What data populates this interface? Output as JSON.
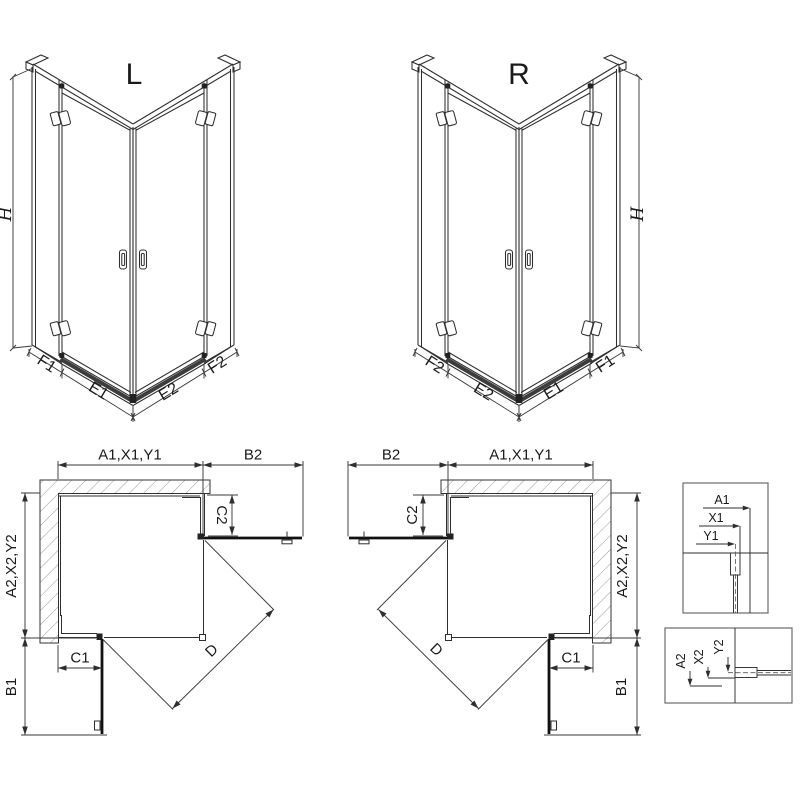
{
  "drawing": {
    "type": "shower-enclosure-technical-drawing",
    "iso_left": {
      "title": "L",
      "height": "H",
      "f1": "F1",
      "e1": "E1",
      "e2": "E2",
      "f2": "F2"
    },
    "iso_right": {
      "title": "R",
      "height": "H",
      "f1": "F1",
      "e1": "E1",
      "e2": "E2",
      "f2": "F2"
    },
    "plan_left": {
      "top_width": "A1,X1,Y1",
      "door_top": "B2",
      "offset_top": "C2",
      "side_width": "A2,X2,Y2",
      "offset_side": "C1",
      "door_side": "B1",
      "diagonal": "D"
    },
    "plan_right": {
      "top_width": "A1,X1,Y1",
      "door_top": "B2",
      "offset_top": "C2",
      "side_width": "A2,X2,Y2",
      "offset_side": "C1",
      "door_side": "B1",
      "diagonal": "D"
    },
    "detail_top": {
      "a": "A1",
      "x": "X1",
      "y": "Y1"
    },
    "detail_bottom": {
      "a": "A2",
      "x": "X2",
      "y": "Y2"
    },
    "colors": {
      "line": "#2e2e2e",
      "dim": "#3a3a3a",
      "dark": "#1c1c1c",
      "hatch": "#8f8f8f",
      "box": "#6a6a6a"
    }
  }
}
